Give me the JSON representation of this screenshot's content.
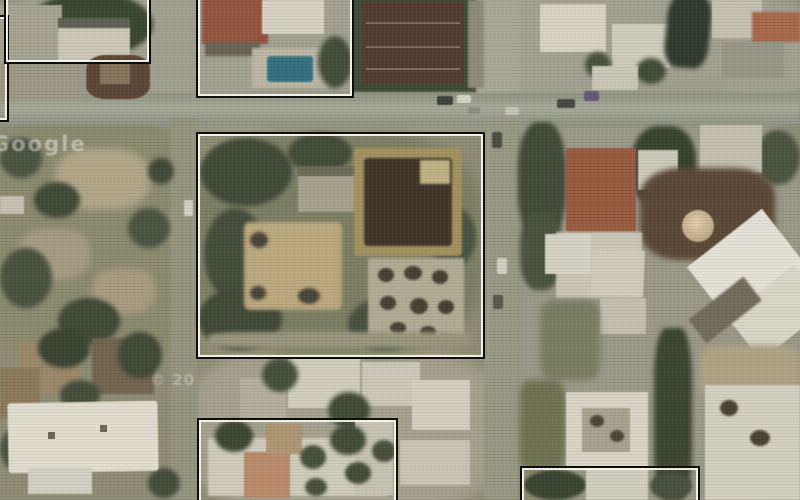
{
  "scene": {
    "type": "satellite aerial photograph",
    "description": "Aerial/satellite view of an urban neighborhood with roads, villas, trees, a swimming pool, sports courts and a circular structure; six rectangular survey annotation boxes outline selected building parcels.",
    "features": [
      "horizontal road",
      "two vertical roads",
      "swimming pool",
      "sports courts",
      "terracotta roof villa",
      "circular tan structure",
      "large angular white building",
      "scrubland",
      "tree clusters",
      "parked cars"
    ]
  },
  "annotations": {
    "style": {
      "outer_border": "#0d0d0d",
      "inner_border": "#f8f8f0"
    },
    "boxes": [
      {
        "name": "box-left-edge-clipped",
        "left": -46,
        "top": 15,
        "width": 51,
        "height": 103
      },
      {
        "name": "box-top-left",
        "left": 4,
        "top": -20,
        "width": 143,
        "height": 80
      },
      {
        "name": "box-top-middle",
        "left": 196,
        "top": -14,
        "width": 154,
        "height": 108
      },
      {
        "name": "box-central-compound",
        "left": 196,
        "top": 132,
        "width": 285,
        "height": 223
      },
      {
        "name": "box-bottom-middle",
        "left": 197,
        "top": 418,
        "width": 197,
        "height": 95
      },
      {
        "name": "box-bottom-right",
        "left": 520,
        "top": 466,
        "width": 176,
        "height": 47
      }
    ]
  },
  "watermarks": [
    {
      "name": "watermark-imagery-brand",
      "text": "Google",
      "left": -8,
      "top": 132
    },
    {
      "name": "watermark-copyright",
      "text": "© 20",
      "left": 150,
      "top": 371
    }
  ],
  "palette": {
    "ground_olive": "#8e8d74",
    "road_gray_green": "#9da18f",
    "tree_dark_green": "#3f4834",
    "roof_white": "#dedacb",
    "roof_terracotta": "#9c5a3d",
    "pool_blue": "#2f6f81",
    "court_maroon": "#543a2e",
    "dirt_tan": "#b3a98a",
    "box_outer": "#0d0d0d",
    "box_inner": "#f8f8f0"
  }
}
